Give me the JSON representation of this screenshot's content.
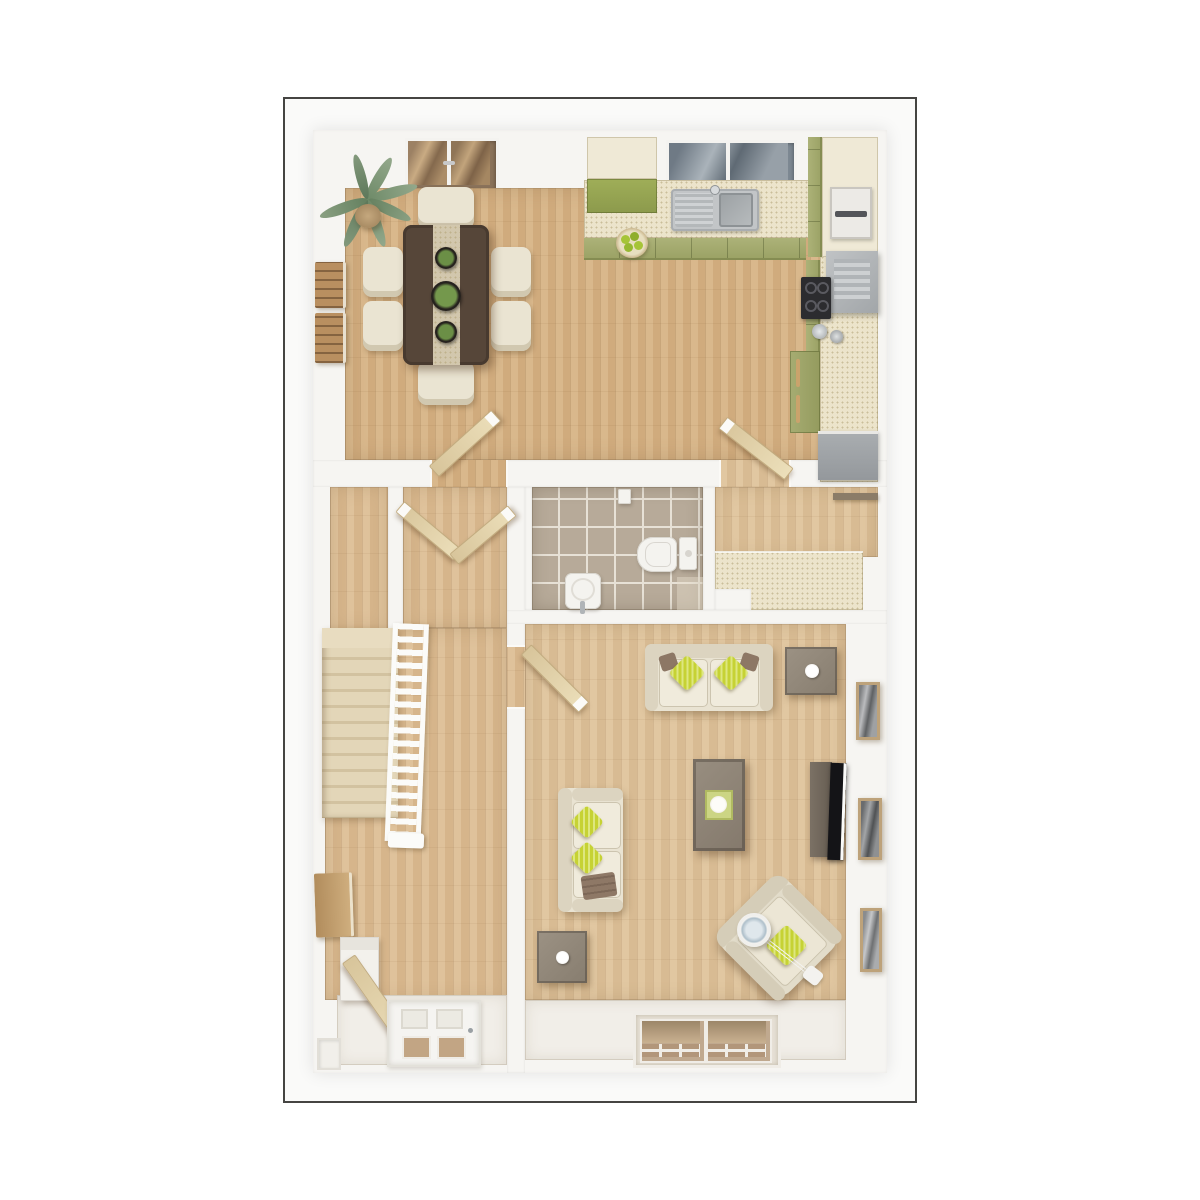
{
  "image": {
    "kind": "architectural 3d floor plan render",
    "view": "top-down dollhouse cutaway of a single storey (ground floor)",
    "visible_text": "none",
    "frame_border_color": "#454442",
    "background_color": "#ffffff"
  },
  "palette": {
    "wall_white": "#f6f5f2",
    "wood_floor_warm": "#d5b284",
    "wood_floor_light": "#dcc096",
    "carpet_stairs": "#ddd0b2",
    "tile_taupe": "#b7aa99",
    "cabinet_olive": "#a3aa6e",
    "counter_cream": "#ece4cb",
    "accent_lime": "#c6d234",
    "sofa_cream": "#e9e3d2",
    "furniture_taupe": "#8f8478",
    "dining_table_brown": "#564639",
    "appliance_gray": "#9ea2a5",
    "glass_tan": "#c4a57e",
    "glass_slate": "#7d8892"
  },
  "rooms": [
    {
      "id": "kitchen-dining",
      "position": "top",
      "floor": "wood",
      "items": [
        "french-doors",
        "window-over-sink",
        "l-shaped-counter",
        "sink-with-drainer",
        "fruit-bowl",
        "tall-unit",
        "microwave",
        "extractor-hood",
        "hob",
        "kettle-and-pot",
        "lower-cabinets",
        "gray-appliance",
        "dining-table",
        "table-runner",
        "three-plant-centerpieces",
        "six-chairs",
        "potted-palm",
        "two-wall-art-panels",
        "two-open-door-leaves"
      ]
    },
    {
      "id": "hallway-vestibule",
      "position": "middle-left",
      "floor": "wood",
      "items": [
        "two-open-door-leaves-v"
      ]
    },
    {
      "id": "staircase",
      "position": "left",
      "floor": "carpet",
      "items": [
        "eleven-steps",
        "white-balustrade",
        "newel-post"
      ]
    },
    {
      "id": "wc-bathroom",
      "position": "middle-center",
      "floor": "tiles",
      "items": [
        "toilet-with-cistern",
        "wash-basin",
        "toilet-roll-holder"
      ]
    },
    {
      "id": "store-cupboard",
      "position": "middle-right",
      "floor": "wood",
      "items": [
        "worktop",
        "shelf"
      ]
    },
    {
      "id": "living-room",
      "position": "bottom-right",
      "floor": "wood",
      "items": [
        "two-seat-sofa",
        "three-seat-sofa",
        "armchair",
        "arc-floor-lamp",
        "coffee-table-with-tray",
        "two-side-tables",
        "tv-unit",
        "tv-screen",
        "three-wall-frames",
        "double-window-bay",
        "open-door-leaf"
      ]
    },
    {
      "id": "entrance-hall",
      "position": "bottom-left",
      "floor": "wood-and-mat",
      "items": [
        "front-door-with-glazing",
        "open-inner-door",
        "wall-shelf",
        "console",
        "storage-niche"
      ]
    }
  ],
  "counts": {
    "chairs": 6,
    "sofas": 2,
    "armchairs": 1,
    "wall_frames": 3,
    "wall_art_panels": 2,
    "windows": 3,
    "external_doors": 2,
    "open_door_leaves": 6,
    "stair_steps": 11
  }
}
